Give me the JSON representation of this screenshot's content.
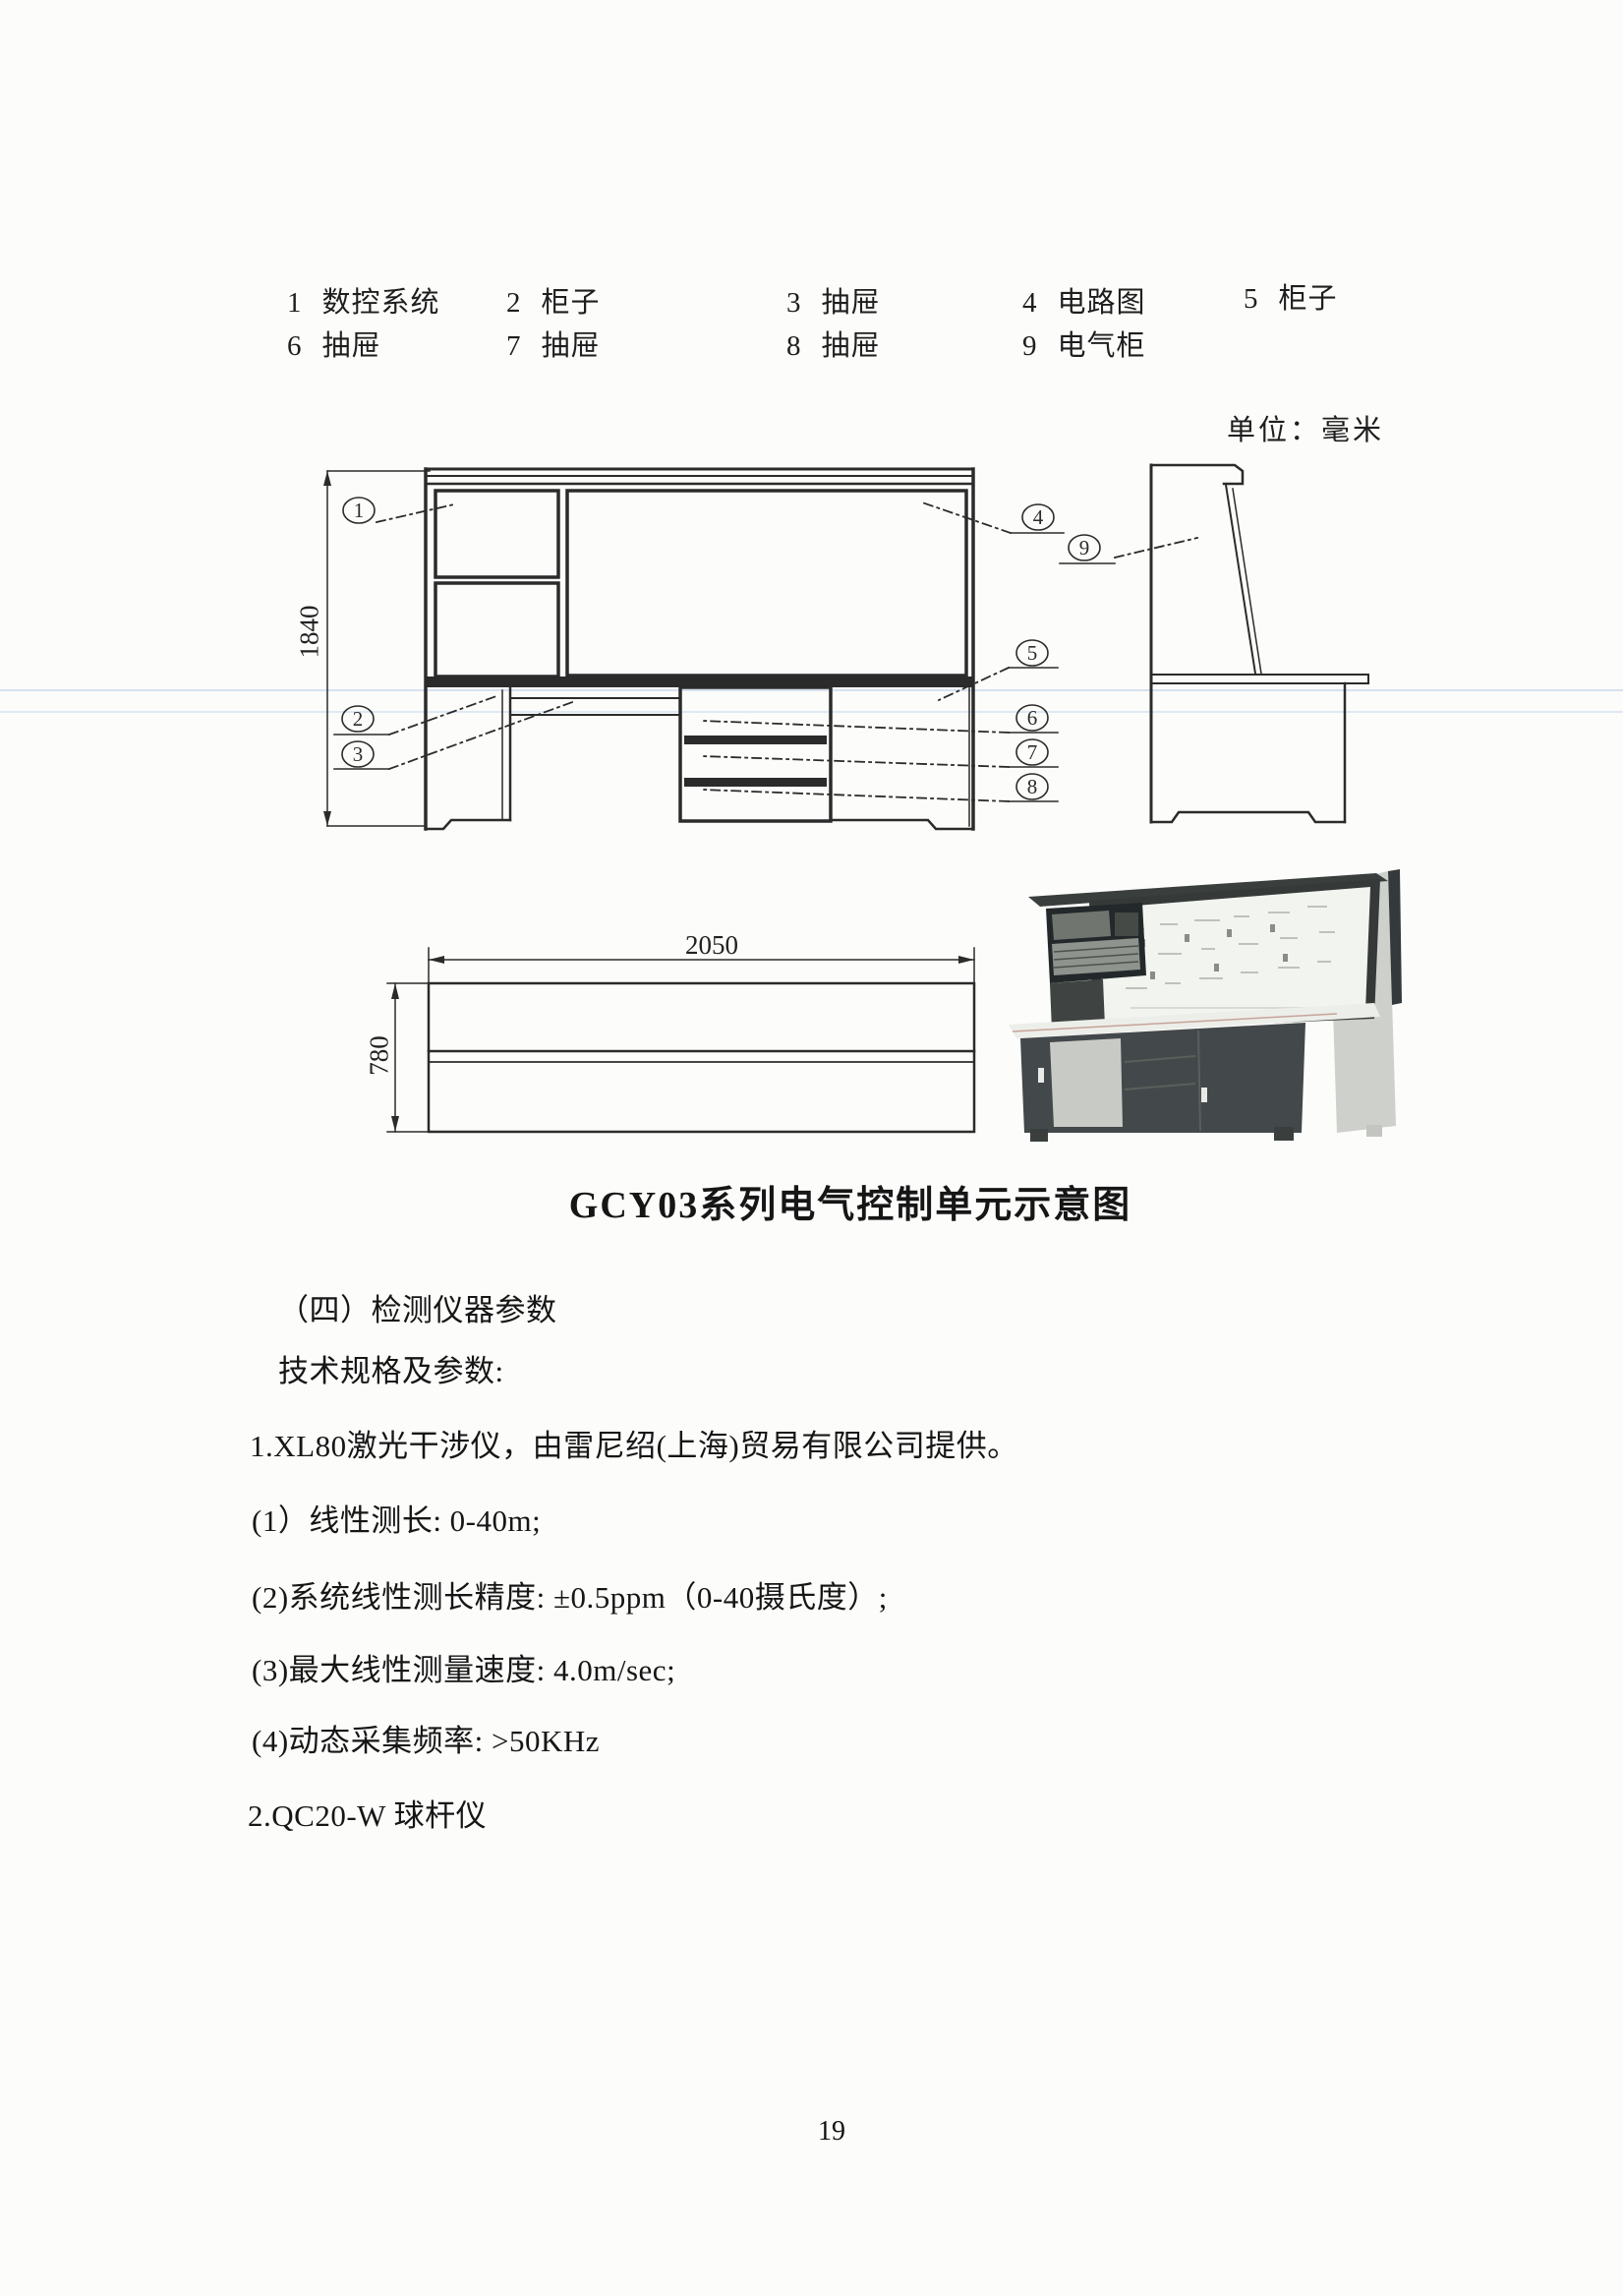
{
  "legend": {
    "items": [
      {
        "num": "1",
        "label": "数控系统"
      },
      {
        "num": "2",
        "label": "柜子"
      },
      {
        "num": "3",
        "label": "抽屉"
      },
      {
        "num": "4",
        "label": "电路图"
      },
      {
        "num": "5",
        "label": "柜子"
      },
      {
        "num": "6",
        "label": "抽屉"
      },
      {
        "num": "7",
        "label": "抽屉"
      },
      {
        "num": "8",
        "label": "抽屉"
      },
      {
        "num": "9",
        "label": "电气柜"
      }
    ]
  },
  "diagram": {
    "unit_label": "单位：毫米",
    "dims": {
      "height": "1840",
      "width": "2050",
      "depth": "780"
    },
    "callouts": [
      "1",
      "2",
      "3",
      "4",
      "5",
      "6",
      "7",
      "8",
      "9"
    ],
    "ink_color": "#2b2b2b"
  },
  "caption": "GCY03系列电气控制单元示意图",
  "body": {
    "lines": [
      "（四）检测仪器参数",
      "技术规格及参数:",
      "1.XL80激光干涉仪，由雷尼绍(上海)贸易有限公司提供。",
      "(1）线性测长: 0-40m;",
      "(2)系统线性测长精度: ±0.5ppm（0-40摄氏度）;",
      "(3)最大线性测量速度: 4.0m/sec;",
      "(4)动态采集频率: >50KHz",
      "2.QC20-W 球杆仪"
    ]
  },
  "page": {
    "number": "19"
  }
}
